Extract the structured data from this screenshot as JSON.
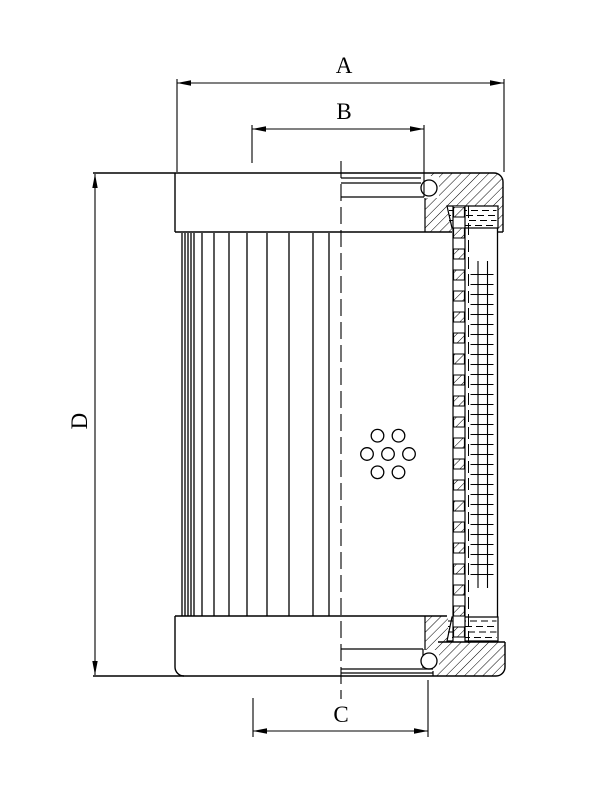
{
  "drawing": {
    "kind": "technical line drawing - filter element cross-section",
    "background_color": "#ffffff",
    "line_color": "#000000",
    "dimension_labels": {
      "a": "A",
      "b": "B",
      "c": "C",
      "d": "D"
    }
  }
}
